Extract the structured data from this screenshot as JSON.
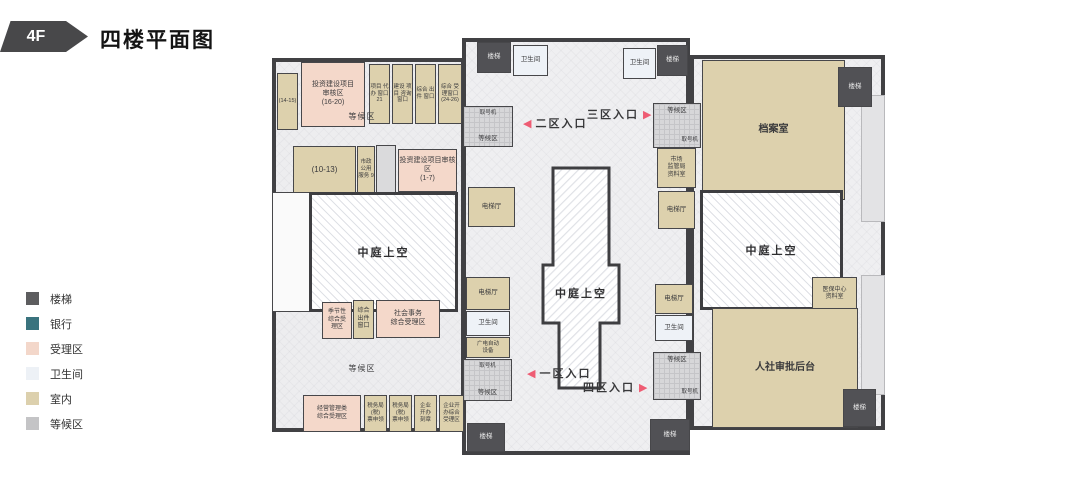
{
  "header": {
    "floor_badge": "4F",
    "title": "四楼平面图"
  },
  "legend": {
    "items": [
      {
        "label": "楼梯",
        "color": "#5d5d5f"
      },
      {
        "label": "银行",
        "color": "#3a737e"
      },
      {
        "label": "受理区",
        "color": "#f3d7ca"
      },
      {
        "label": "卫生间",
        "color": "#edf1f6"
      },
      {
        "label": "室内",
        "color": "#dcd0ad"
      },
      {
        "label": "等候区",
        "color": "#c4c4c6"
      }
    ]
  },
  "plan": {
    "shared": {
      "stairs": "楼梯",
      "restroom": "卫生间",
      "elevator_hall": "电梯厅",
      "waiting_area": "等候区",
      "number_machine": "取号机",
      "atrium": "中庭上空"
    },
    "rooms": {
      "room_14_15": "(14-15)",
      "invest_16_20": "投资建设项目\n审核区\n(16-20)",
      "window_21": "项目 代办 窗口 21",
      "window_construction": "建设 项目 咨询 窗口",
      "window_output_top": "综合 出件 窗口",
      "window_accept_24_26": "综合 受理窗口 (24-26)",
      "room_10_13": "(10-13)",
      "municipal_service": "市政 公用 服务 9",
      "invest_1_7": "投资建设项目审核区\n(1-7)",
      "seasonal": "季节性\n综合受\n理区",
      "window_output_bottom": "综合\n出件\n窗口",
      "social_affairs": "社会事务\n综合受理区",
      "mgmt_accept": "经营管理类\n综合受理区",
      "tax_window_1": "税务局\n(税)\n票申领",
      "tax_window_2": "税务局\n(税)\n票申领",
      "biz_seal": "企业\n开办\n刻章",
      "biz_accept": "企业开\n办综合\n受理区",
      "broadcast_equipment": "广电自动\n设备",
      "market_bureau": "市场\n监管局\n资料室",
      "archive": "档案室",
      "medical_center": "医保中心\n资料室",
      "hr_backend": "人社审批后台"
    },
    "entrances": {
      "zone1": "一区入口",
      "zone2": "二区入口",
      "zone3": "三区入口",
      "zone4": "四区入口"
    }
  }
}
